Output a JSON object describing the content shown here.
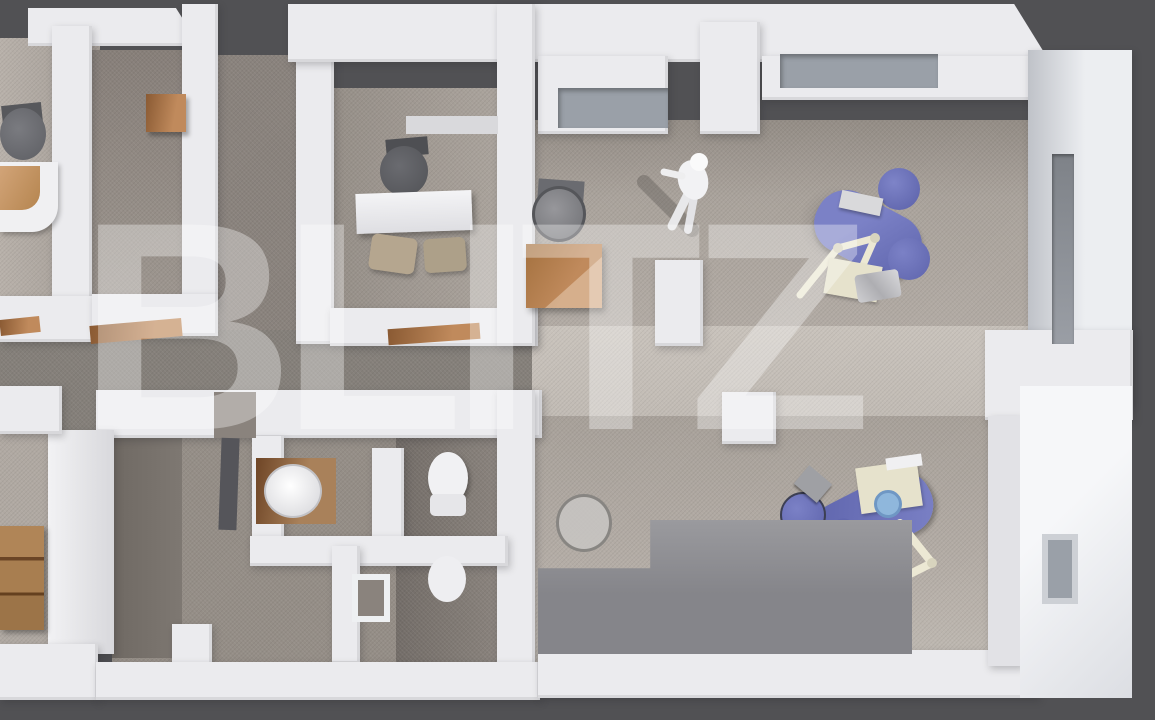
{
  "watermark": {
    "text": "BLITZ"
  },
  "colors": {
    "background": "#515154",
    "wall": "#ebebee",
    "floor": "#b3aca5",
    "floor_shadow": "#8d8680",
    "floor_light": "#c6c0b9",
    "wood": "#c08a5c",
    "dental_chair_blue": "#7177bf",
    "dental_unit_cream": "#e6e2cc",
    "fixture_white": "#f2f2f4",
    "recess": "#9aa0a8"
  },
  "scene": {
    "kind": "3d-floor-plan-top-down-render",
    "rooms": [
      "left-office",
      "meeting-room",
      "private-office",
      "reception-open-space",
      "treatment-area-top",
      "treatment-area-bottom",
      "bathrooms",
      "corridor",
      "storage-room"
    ],
    "objects": [
      "office-chair",
      "curved-reception-desk",
      "wall-shelf",
      "office-desk",
      "visitor-chairs",
      "standing-person",
      "dental-chair-unit-1",
      "dental-chair-unit-2",
      "dental-stools",
      "toilets",
      "round-sink",
      "wooden-cabinet",
      "l-shaped-counter",
      "open-wooden-doors",
      "windows"
    ]
  }
}
